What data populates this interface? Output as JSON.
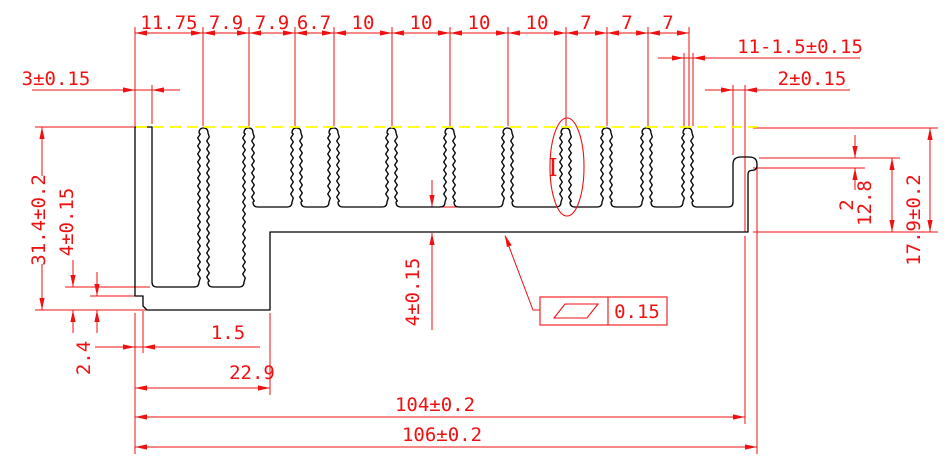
{
  "colors": {
    "profile_outline": "#000000",
    "dimension_red": "#f01010",
    "centerline_yellow": "#ffff00",
    "background": "#ffffff"
  },
  "dimensions": {
    "top_chain": [
      "11.75",
      "7.9",
      "7.9",
      "6.7",
      "10",
      "10",
      "10",
      "10",
      "7",
      "7",
      "7"
    ],
    "wall_thickness": "3±0.15",
    "fin_spec": "11-1.5±0.15",
    "lip_thickness": "2±0.15",
    "overall_height": "31.4±0.2",
    "left_base_thickness": "4±0.15",
    "notch_height": "2.4",
    "notch_width": "1.5",
    "left_width": "22.9",
    "base_thickness": "4±0.15",
    "lip_step": "2",
    "lip_height": "12.8",
    "right_height": "17.9±0.2",
    "width_inner": "104±0.2",
    "width_overall": "106±0.2",
    "flatness": "0.15",
    "detail_label": "I"
  }
}
